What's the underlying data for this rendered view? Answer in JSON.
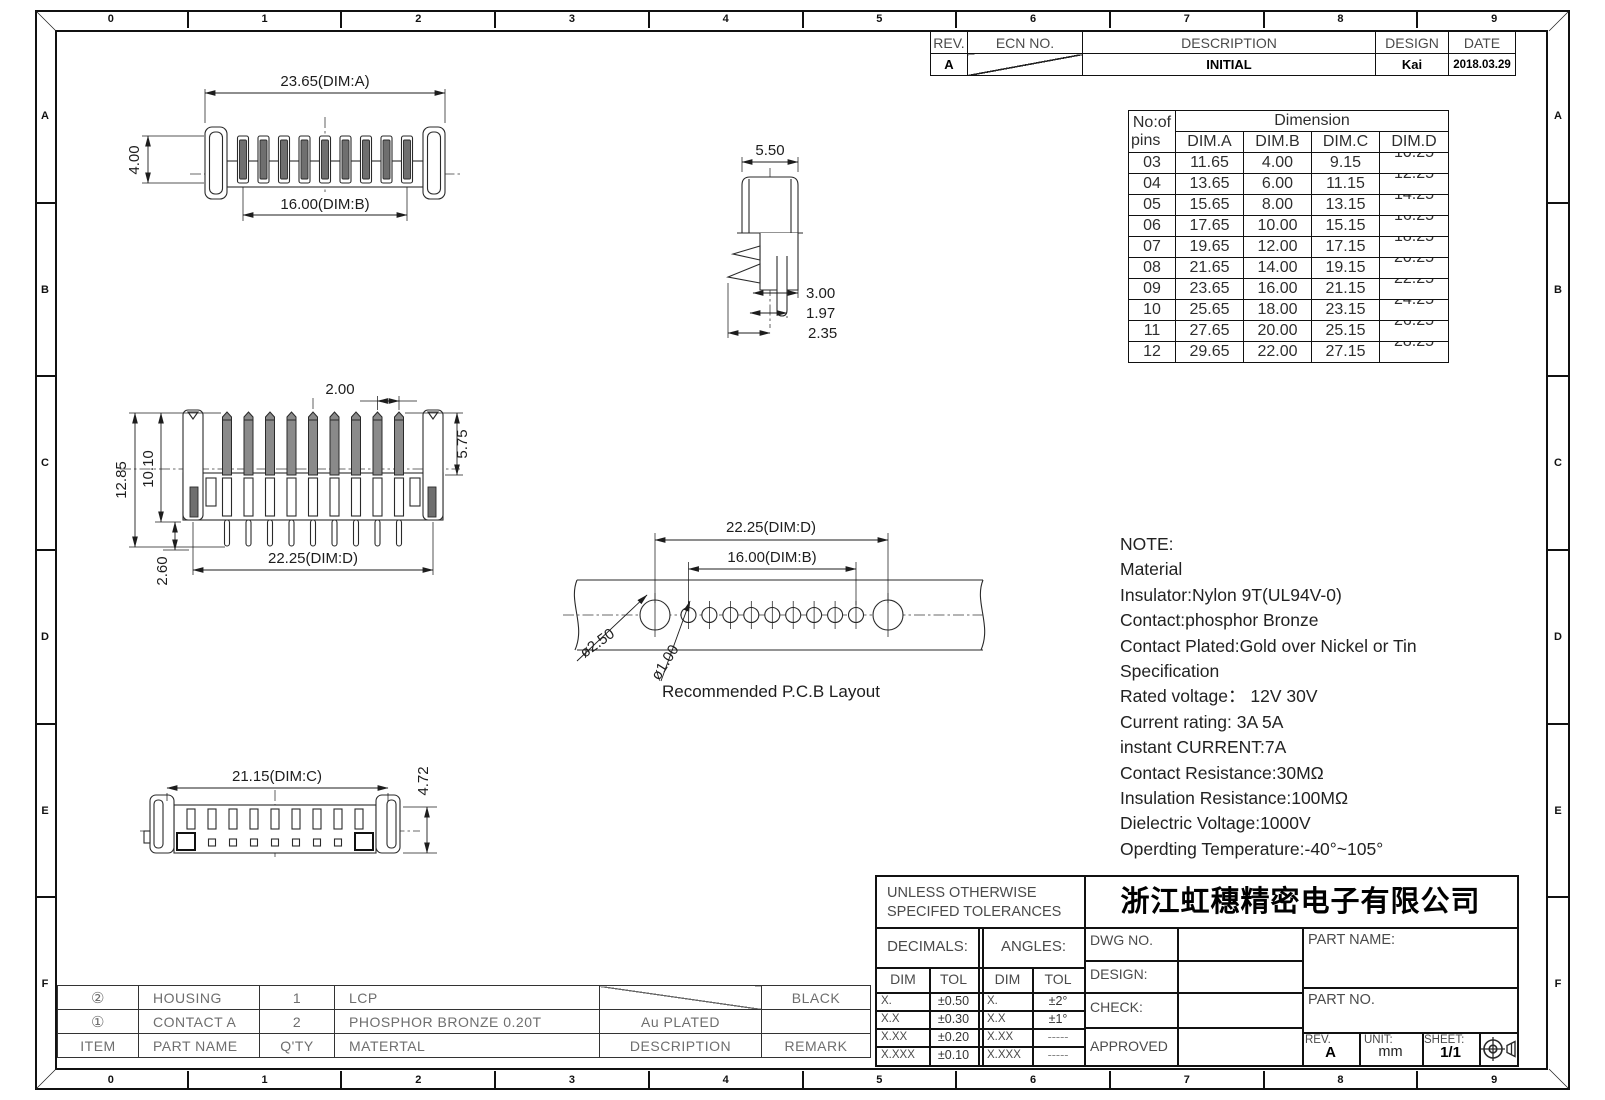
{
  "sheet": {
    "grid_cols": [
      "0",
      "1",
      "2",
      "3",
      "4",
      "5",
      "6",
      "7",
      "8",
      "9"
    ],
    "grid_rows": [
      "A",
      "B",
      "C",
      "D",
      "E",
      "F"
    ]
  },
  "revision_table": {
    "headers": {
      "rev": "REV.",
      "ecn": "ECN  NO.",
      "description": "DESCRIPTION",
      "design": "DESIGN",
      "date": "DATE"
    },
    "row": {
      "rev": "A",
      "description": "INITIAL",
      "design": "Kai",
      "date": "2018.03.29"
    }
  },
  "dimension_table": {
    "col1_line1": "No:of",
    "col1_line2": "pins",
    "span_header": "Dimension",
    "col_headers": [
      "DIM.A",
      "DIM.B",
      "DIM.C",
      "DIM.D"
    ],
    "rows": [
      {
        "pins": "03",
        "a": "11.65",
        "b": "4.00",
        "c": "9.15",
        "d": "10.25"
      },
      {
        "pins": "04",
        "a": "13.65",
        "b": "6.00",
        "c": "11.15",
        "d": "12.25"
      },
      {
        "pins": "05",
        "a": "15.65",
        "b": "8.00",
        "c": "13.15",
        "d": "14.25"
      },
      {
        "pins": "06",
        "a": "17.65",
        "b": "10.00",
        "c": "15.15",
        "d": "16.25"
      },
      {
        "pins": "07",
        "a": "19.65",
        "b": "12.00",
        "c": "17.15",
        "d": "18.25"
      },
      {
        "pins": "08",
        "a": "21.65",
        "b": "14.00",
        "c": "19.15",
        "d": "20.25"
      },
      {
        "pins": "09",
        "a": "23.65",
        "b": "16.00",
        "c": "21.15",
        "d": "22.25"
      },
      {
        "pins": "10",
        "a": "25.65",
        "b": "18.00",
        "c": "23.15",
        "d": "24.25"
      },
      {
        "pins": "11",
        "a": "27.65",
        "b": "20.00",
        "c": "25.15",
        "d": "26.25"
      },
      {
        "pins": "12",
        "a": "29.65",
        "b": "22.00",
        "c": "27.15",
        "d": "28.25"
      }
    ]
  },
  "views": {
    "top": {
      "dim_a": "23.65(DIM:A)",
      "height": "4.00",
      "dim_b": "16.00(DIM:B)"
    },
    "side": {
      "width": "5.50",
      "d1": "3.00",
      "d2": "1.97",
      "d3": "2.35"
    },
    "front": {
      "pitch": "2.00",
      "total_height": "12.85",
      "body_height": "10.10",
      "pin_height": "5.75",
      "tail": "2.60",
      "dim_d": "22.25(DIM:D)"
    },
    "pcb": {
      "dim_d": "22.25(DIM:D)",
      "dim_b": "16.00(DIM:B)",
      "big_hole": "ø2.50",
      "small_hole": "ø1.00",
      "caption": "Recommended  P.C.B  Layout"
    },
    "bottom": {
      "dim_c": "21.15(DIM:C)",
      "height": "4.72"
    }
  },
  "notes": {
    "lines": [
      "NOTE:",
      "Material",
      "Insulator:Nylon  9T(UL94V-0)",
      "Contact:phosphor  Bronze",
      "Contact  Plated:Gold  over  Nickel  or  Tin",
      "Specification",
      "Rated  voltage：  12V  30V",
      "Current  rating:  3A    5A",
      "instant  CURRENT:7A",
      "Contact  Resistance:30MΩ",
      "Insulation  Resistance:100MΩ",
      "Dielectric  Voltage:1000V",
      "Operdting  Temperature:-40°~105°"
    ]
  },
  "title_block": {
    "tolerance_line1": "UNLESS  OTHERWISE",
    "tolerance_line2": "SPECIFED  TOLERANCES",
    "company": "浙江虹穗精密电子有限公司",
    "decimals_label": "DECIMALS:",
    "angles_label": "ANGLES:",
    "dim_label": "DIM",
    "tol_label": "TOL",
    "decimals_rows": [
      [
        "X.",
        "±0.50"
      ],
      [
        "X.X",
        "±0.30"
      ],
      [
        "X.XX",
        "±0.20"
      ],
      [
        "X.XXX",
        "±0.10"
      ]
    ],
    "angles_rows": [
      [
        "X.",
        "±2°"
      ],
      [
        "X.X",
        "±1°"
      ],
      [
        "X.XX",
        "-----"
      ],
      [
        "X.XXX",
        "-----"
      ]
    ],
    "dwg_no_label": "DWG  NO.",
    "design_label": "DESIGN:",
    "check_label": "CHECK:",
    "approved_label": "APPROVED",
    "part_name_label": "PART  NAME:",
    "part_no_label": "PART  NO.",
    "rev_label": "REV.",
    "rev_value": "A",
    "unit_label": "UNIT:",
    "unit_value": "mm",
    "sheet_label": "SHEET:",
    "sheet_value": "1/1"
  },
  "parts_table": {
    "headers": {
      "item": "ITEM",
      "part_name": "PART  NAME",
      "qty": "Q'TY",
      "material": "MATERTAL",
      "description": "DESCRIPTION",
      "remark": "REMARK"
    },
    "rows": [
      {
        "item": "②",
        "part_name": "HOUSING",
        "qty": "1",
        "material": "LCP",
        "description": "",
        "remark": "BLACK"
      },
      {
        "item": "①",
        "part_name": "CONTACT  A",
        "qty": "2",
        "material": "PHOSPHOR  BRONZE  0.20T",
        "description": "Au  PLATED",
        "remark": ""
      }
    ]
  }
}
